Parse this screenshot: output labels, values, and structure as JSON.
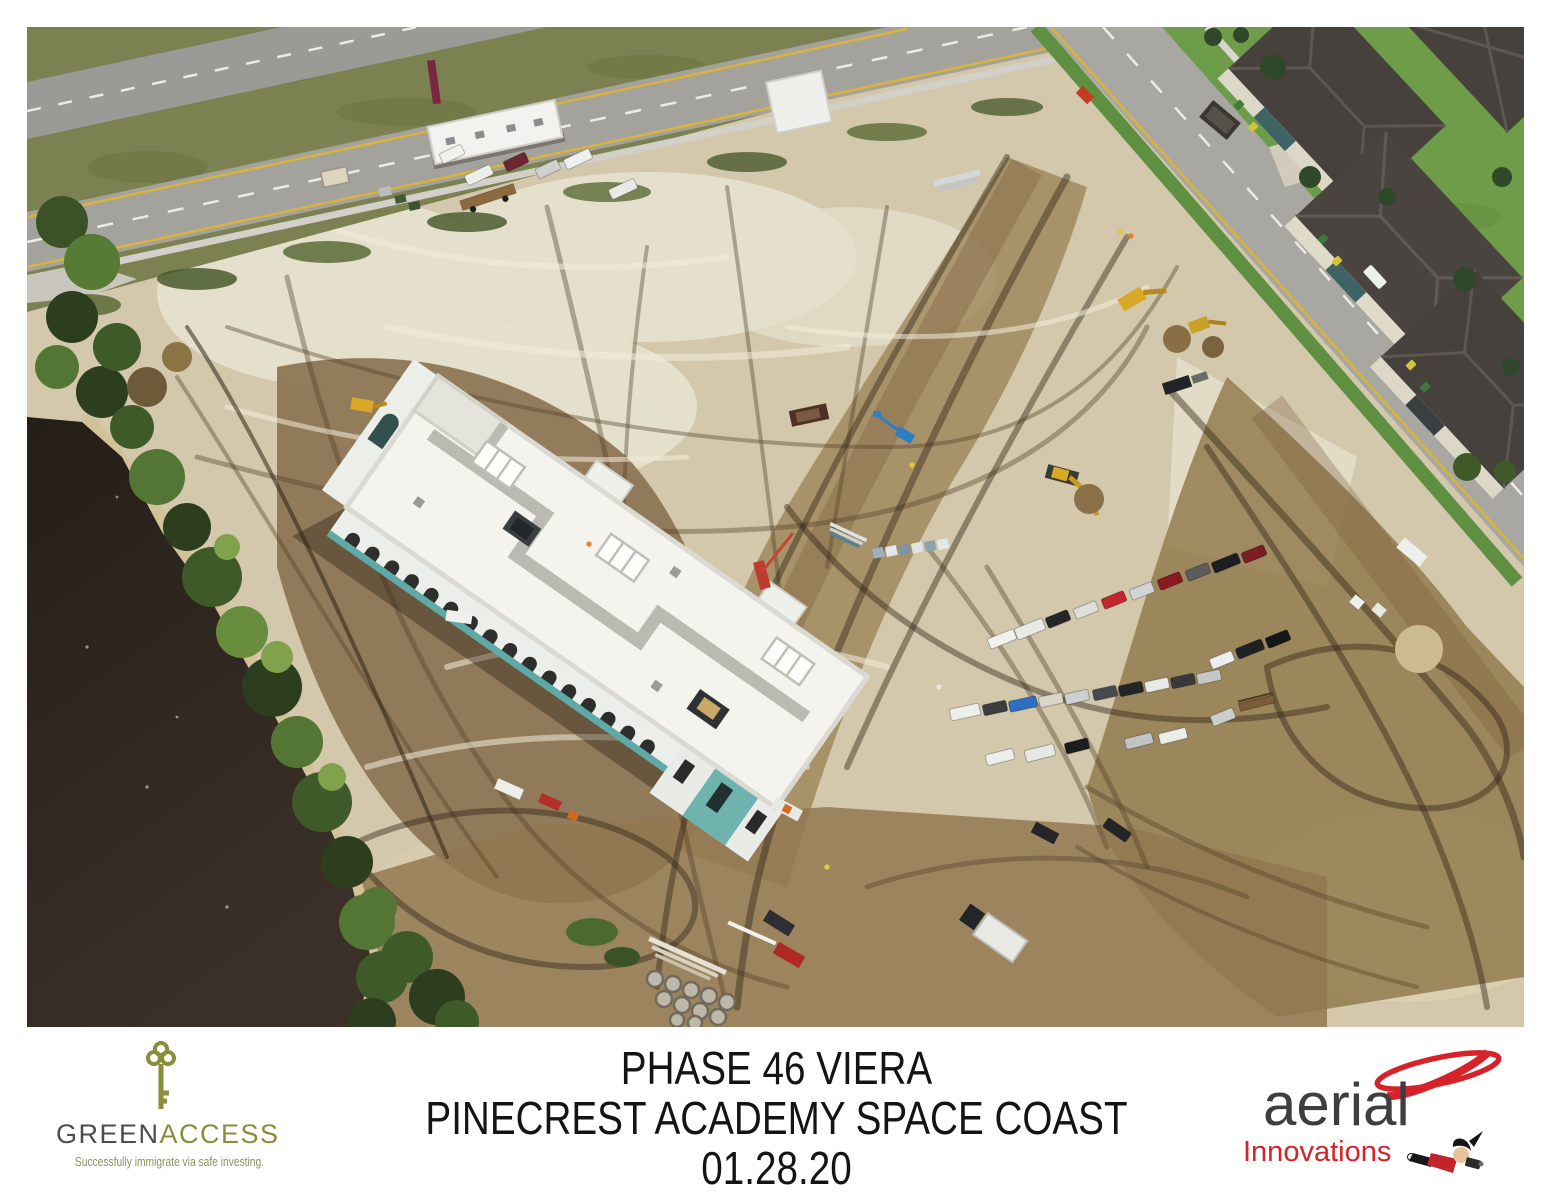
{
  "page": {
    "width": 1553,
    "height": 1200,
    "background": "#ffffff"
  },
  "photo": {
    "description": "Aerial photograph of the Pinecrest Academy Space Coast school construction site in Viera: a long white-roofed two-story building with teal trim stands on cleared sandy ground criss-crossed by equipment tire tracks; a dark tree-lined pond borders the left edge, a divided road runs along the top left, a residential street with gray-roofed homes fills the top right, and rows of parked cars, trucks, trailers and excavators dot the dirt site.",
    "palette": {
      "sand": "#d3c8ab",
      "bright_sand": "#e7e2d0",
      "dirt": "#8a7150",
      "dark_mud": "#5e4a30",
      "water": "#2b241d",
      "trees": "#3d5628",
      "grass_verge": "#7b8150",
      "lawn": "#6f9c48",
      "asphalt": "#a3a29d",
      "roof_white": "#f4f3ee",
      "building_teal": "#5fa9a6",
      "house_roof": "#46413d"
    }
  },
  "footer": {
    "greenaccess": {
      "name_green": "GREEN",
      "name_access": "ACCESS",
      "tagline": "Successfully immigrate via safe investing.",
      "color_dark": "#4d4e49",
      "color_olive": "#8b8d3a"
    },
    "caption": {
      "line1": "PHASE 46 VIERA",
      "line2": "PINECREST ACADEMY SPACE COAST",
      "line3": "01.28.20",
      "color": "#141414"
    },
    "aerial_innovations": {
      "word_top": "aerial",
      "word_bottom": "Innovations",
      "color_dark": "#3e3e40",
      "color_red": "#d6232a"
    }
  }
}
